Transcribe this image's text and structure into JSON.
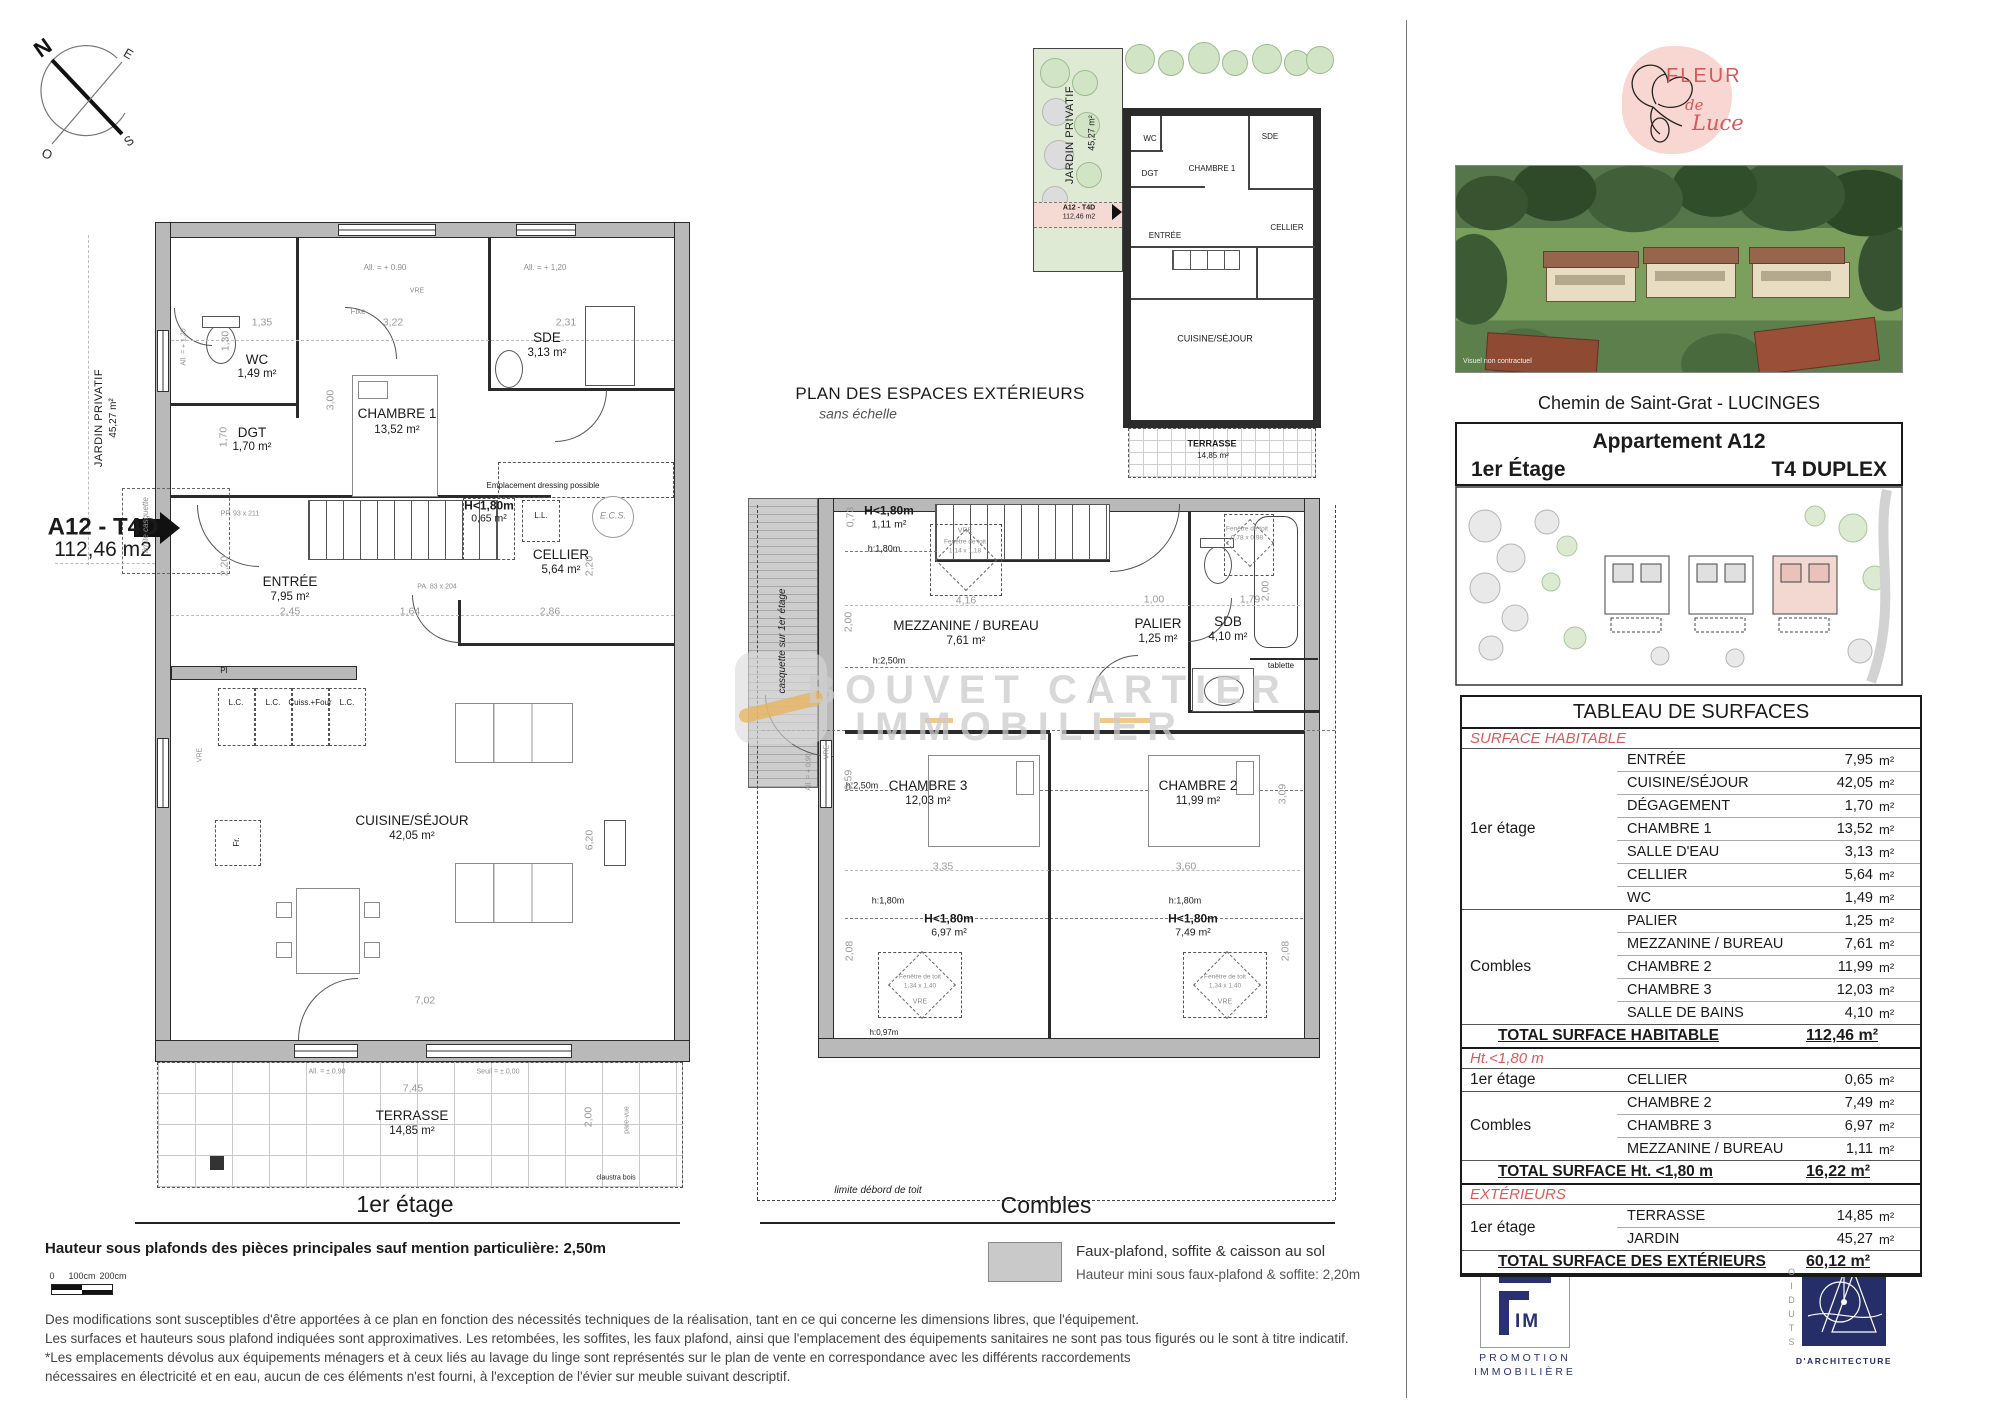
{
  "compass": {
    "n": "N",
    "e": "E",
    "s": "S",
    "o": "O"
  },
  "p1": {
    "floor_label": "1er étage",
    "tag_code": "A12 - T4D",
    "tag_area": "112,46 m2",
    "jardin_label": "JARDIN PRIVATIF",
    "jardin_area": "45,27 m²",
    "rooms": {
      "wc": {
        "name": "WC",
        "area": "1,49 m²"
      },
      "dgt": {
        "name": "DGT",
        "area": "1,70 m²"
      },
      "chambre1": {
        "name": "CHAMBRE 1",
        "area": "13,52 m²"
      },
      "sde": {
        "name": "SDE",
        "area": "3,13 m²"
      },
      "entree": {
        "name": "ENTRÉE",
        "area": "7,95 m²"
      },
      "cellier": {
        "name": "CELLIER",
        "area": "5,64 m²"
      },
      "h180": {
        "name": "H<1,80m",
        "area": "0,65 m²"
      },
      "cuisine": {
        "name": "CUISINE/SÉJOUR",
        "area": "42,05 m²"
      },
      "terrasse": {
        "name": "TERRASSE",
        "area": "14,85 m²"
      }
    },
    "ann": {
      "all090": "All. = + 0.90",
      "all120": "All. = + 1,20",
      "vre": "VRE",
      "fixe": "Fixe",
      "dressing": "Emplacement dressing possible",
      "ll": "L.L.",
      "ecs": "E.C.S.",
      "pi": "PI",
      "lc": "L.C.",
      "cuiss": "Cuiss.+Four",
      "fr": "Fr.",
      "allpm": "All. = ± 0,90",
      "seuil": "Seuil = ± 0,00",
      "pare": "pare-vue",
      "claustra": "claustra bois",
      "pp": "PP. 93 x 211",
      "pa": "PA. 83 x 204",
      "limite": "limite casquette"
    },
    "dims": {
      "d135": "1,35",
      "d322": "3,22",
      "d231": "2,31",
      "d300": "3,00",
      "d170": "1,70",
      "d130": "1,30",
      "d220": "2,20",
      "d245": "2,45",
      "d164": "1,64",
      "d286": "2,86",
      "d620": "6,20",
      "d702": "7,02",
      "d745": "7,45",
      "d200": "2,00"
    }
  },
  "p2": {
    "floor_label": "Combles",
    "casquette": "casquette sur 1er étage",
    "limite": "limite débord de toit",
    "rooms": {
      "h180a": {
        "name": "H<1,80m",
        "area": "1,11 m²"
      },
      "mezzanine": {
        "name": "MEZZANINE / BUREAU",
        "area": "7,61 m²"
      },
      "palier": {
        "name": "PALIER",
        "area": "1,25 m²"
      },
      "sdb": {
        "name": "SDB",
        "area": "4,10 m²"
      },
      "chambre3": {
        "name": "CHAMBRE 3",
        "area": "12,03 m²"
      },
      "chambre2": {
        "name": "CHAMBRE 2",
        "area": "11,99 m²"
      },
      "h180b": {
        "name": "H<1,80m",
        "area": "6,97 m²"
      },
      "h180c": {
        "name": "H<1,80m",
        "area": "7,49 m²"
      }
    },
    "ann": {
      "h180": "h:1,80m",
      "h250": "h:2,50m",
      "h097": "h:0,97m",
      "fdt": "Fenêtre de toit",
      "fdt1size": "1,14 x 1,18",
      "fdt2size": "0,78 x 0,98",
      "fdt3size": "1,34 x 1,40",
      "vre": "VRE",
      "tablette": "tablette",
      "all090v": "All. = + 0,90"
    },
    "dims": {
      "d073": "0,73",
      "d416": "4,16",
      "d200l": "2,00",
      "d100": "1,00",
      "d179": "1,79",
      "d200r": "2,00",
      "d335": "3,35",
      "d360": "3,60",
      "d309": "3,09",
      "d059": "0,59",
      "d208": "2,08"
    }
  },
  "ext": {
    "title": "PLAN DES ESPACES EXTÉRIEURS",
    "subtitle": "sans échelle",
    "jardin": "JARDIN PRIVATIF",
    "jardin_area": "45,27 m²",
    "tag_code": "A12 - T4D",
    "tag_area": "112,46 m2",
    "rooms": {
      "wc": "WC",
      "sde": "SDE",
      "dgt": "DGT",
      "chambre1": "CHAMBRE 1",
      "entree": "ENTRÉE",
      "cellier": "CELLIER",
      "cuisine": "CUISINE/SÉJOUR",
      "terrasse": "TERRASSE",
      "terrasse_area": "14,85 m²"
    }
  },
  "wm": {
    "line1": "BOUVET CARTIER",
    "line2": "IMMOBILIER"
  },
  "sidebar": {
    "logo": {
      "fleur": "FLEUR",
      "de": "de",
      "luce": "Luce"
    },
    "photo_caption": "Visuel non contractuel",
    "address": "Chemin de Saint-Grat - LUCINGES",
    "apartment": {
      "title": "Appartement A12",
      "floor": "1er Étage",
      "type": "T4 DUPLEX"
    },
    "table": {
      "title": "TABLEAU DE SURFACES",
      "unit": "m²",
      "sections": [
        {
          "header": "SURFACE HABITABLE",
          "groups": [
            {
              "label": "1er étage",
              "rows": [
                [
                  "ENTRÉE",
                  "7,95"
                ],
                [
                  "CUISINE/SÉJOUR",
                  "42,05"
                ],
                [
                  "DÉGAGEMENT",
                  "1,70"
                ],
                [
                  "CHAMBRE 1",
                  "13,52"
                ],
                [
                  "SALLE D'EAU",
                  "3,13"
                ],
                [
                  "CELLIER",
                  "5,64"
                ],
                [
                  "WC",
                  "1,49"
                ]
              ]
            },
            {
              "label": "Combles",
              "rows": [
                [
                  "PALIER",
                  "1,25"
                ],
                [
                  "MEZZANINE / BUREAU",
                  "7,61"
                ],
                [
                  "CHAMBRE 2",
                  "11,99"
                ],
                [
                  "CHAMBRE 3",
                  "12,03"
                ],
                [
                  "SALLE DE BAINS",
                  "4,10"
                ]
              ]
            }
          ],
          "total": {
            "label": "TOTAL SURFACE HABITABLE",
            "value": "112,46 m²"
          }
        },
        {
          "header": "Ht.<1,80 m",
          "groups": [
            {
              "label": "1er étage",
              "rows": [
                [
                  "CELLIER",
                  "0,65"
                ]
              ]
            },
            {
              "label": "Combles",
              "rows": [
                [
                  "CHAMBRE 2",
                  "7,49"
                ],
                [
                  "CHAMBRE 3",
                  "6,97"
                ],
                [
                  "MEZZANINE / BUREAU",
                  "1,11"
                ]
              ]
            }
          ],
          "total": {
            "label": "TOTAL SURFACE Ht. <1,80 m",
            "value": "16,22 m²"
          }
        },
        {
          "header": "EXTÉRIEURS",
          "groups": [
            {
              "label": "1er étage",
              "rows": [
                [
                  "TERRASSE",
                  "14,85"
                ],
                [
                  "JARDIN",
                  "45,27"
                ]
              ]
            }
          ],
          "total": {
            "label": "TOTAL SURFACE  DES EXTÉRIEURS",
            "value": "60,12 m²"
          }
        }
      ]
    },
    "commercialisateur": "COMMERCIALISATEUR",
    "edition": {
      "label": "Date d'édition :",
      "value": "10/07/25"
    },
    "fim": {
      "im": "IM",
      "sub1": "PROMOTION",
      "sub2": "IMMOBILIÈRE"
    },
    "studio": {
      "vertical": "STUDIO",
      "sub": "D'ARCHITECTURE"
    }
  },
  "footer": {
    "height_note": "Hauteur sous plafonds des pièces principales sauf mention particulière: 2,50m",
    "scale": {
      "zero": "0",
      "s100": "100cm",
      "s200": "200cm"
    },
    "legend": {
      "line1": "Faux-plafond, soffite & caisson au sol",
      "line2": "Hauteur mini sous faux-plafond & soffite: 2,20m"
    },
    "disclaimer1": "Des modifications sont susceptibles d'être apportées à ce plan en fonction des nécessités techniques de la réalisation, tant en ce qui concerne les dimensions libres, que l'équipement.",
    "disclaimer2": "Les surfaces et hauteurs sous plafond indiquées sont approximatives. Les retombées, les soffites, les faux plafond, ainsi que l'emplacement des équipements sanitaires ne sont pas tous figurés ou le sont à titre indicatif.",
    "disclaimer3": "*Les emplacements dévolus aux équipements ménagers et à ceux liés au lavage du linge sont représentés sur le plan de vente en correspondance avec les différents raccordements",
    "disclaimer4": "nécessaires en électricité et en eau, aucun de ces éléments n'est fourni, à l'exception de l'évier sur meuble suivant descriptif."
  },
  "colors": {
    "accent_red": "#d95b5b",
    "wall_gray": "#b9b9b9",
    "jardin_green": "#dfead5",
    "navy": "#252e68",
    "pink_blob": "#f8d6d1",
    "watermark_orange": "#eab158"
  }
}
